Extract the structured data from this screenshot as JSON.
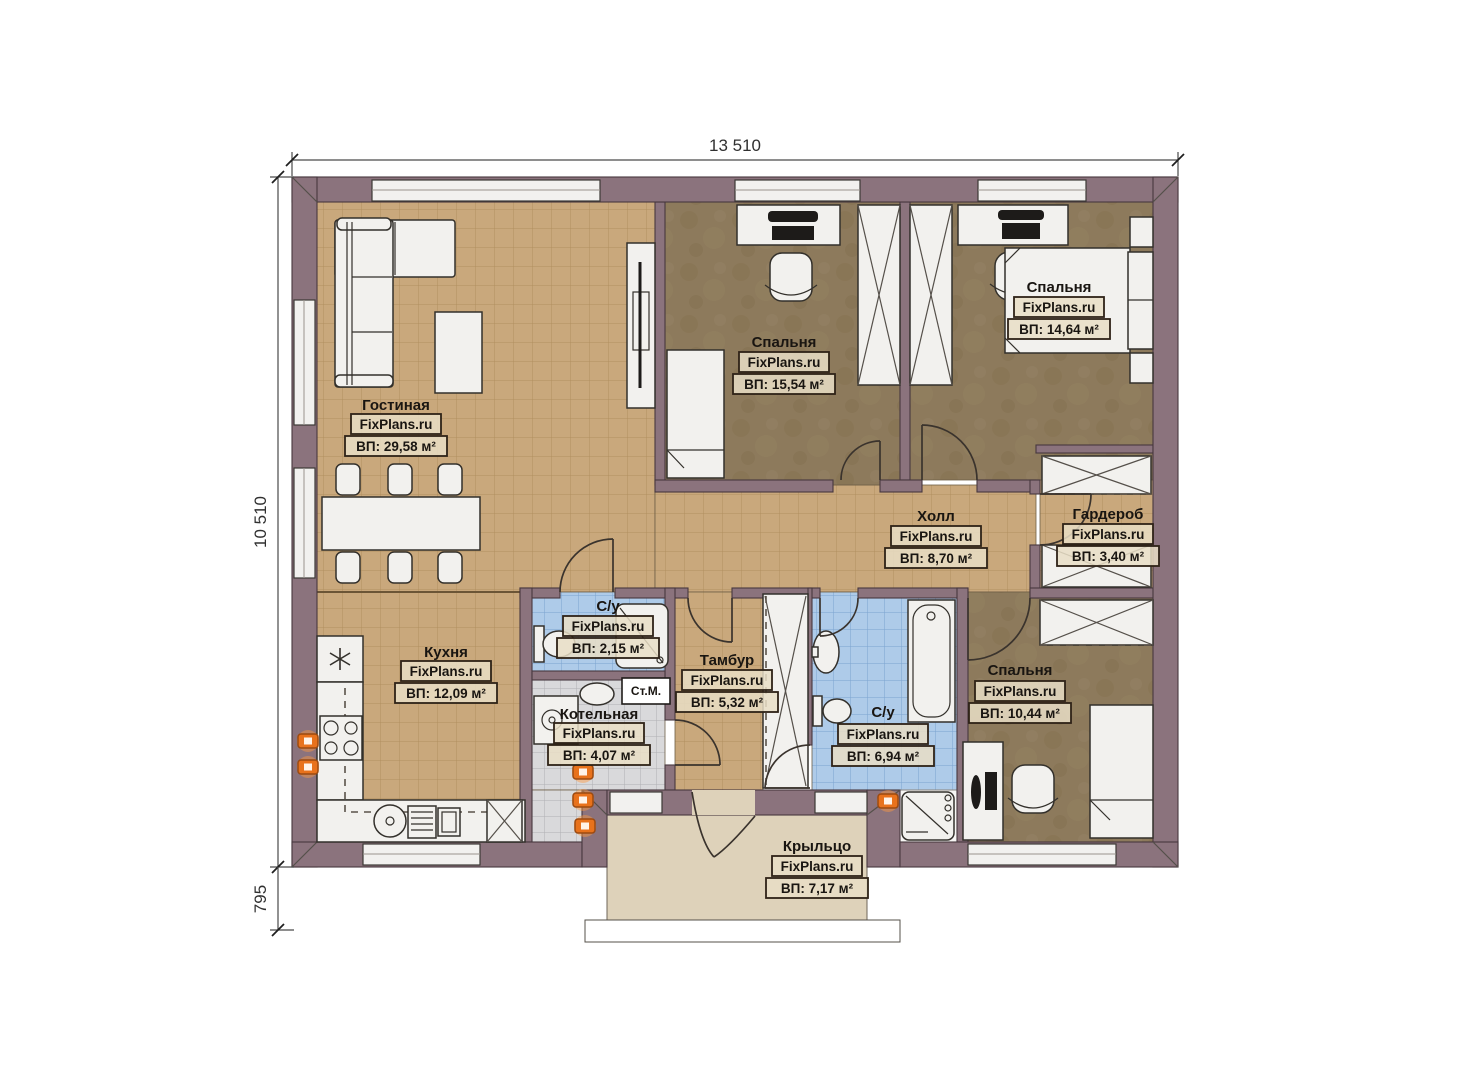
{
  "dimensions": {
    "top": "13 510",
    "left": "10 510",
    "porch": "795"
  },
  "rooms": [
    {
      "id": "living",
      "name": "Гостиная",
      "brand": "FixPlans.ru",
      "area": "ВП: 29,58 м²"
    },
    {
      "id": "bedroom1",
      "name": "Спальня",
      "brand": "FixPlans.ru",
      "area": "ВП: 15,54 м²"
    },
    {
      "id": "bedroom2",
      "name": "Спальня",
      "brand": "FixPlans.ru",
      "area": "ВП: 14,64 м²"
    },
    {
      "id": "hall",
      "name": "Холл",
      "brand": "FixPlans.ru",
      "area": "ВП: 8,70 м²"
    },
    {
      "id": "wardrobe",
      "name": "Гардероб",
      "brand": "FixPlans.ru",
      "area": "ВП: 3,40 м²"
    },
    {
      "id": "kitchen",
      "name": "Кухня",
      "brand": "FixPlans.ru",
      "area": "ВП: 12,09 м²"
    },
    {
      "id": "bath_small",
      "name": "С/у",
      "brand": "FixPlans.ru",
      "area": "ВП: 2,15 м²"
    },
    {
      "id": "vestibule",
      "name": "Тамбур",
      "brand": "FixPlans.ru",
      "area": "ВП: 5,32 м²"
    },
    {
      "id": "boiler",
      "name": "Котельная",
      "brand": "FixPlans.ru",
      "area": "ВП: 4,07 м²"
    },
    {
      "id": "bath_big",
      "name": "С/у",
      "brand": "FixPlans.ru",
      "area": "ВП: 6,94 м²"
    },
    {
      "id": "bedroom3",
      "name": "Спальня",
      "brand": "FixPlans.ru",
      "area": "ВП: 10,44 м²"
    },
    {
      "id": "porch",
      "name": "Крыльцо",
      "brand": "FixPlans.ru",
      "area": "ВП: 7,17 м²"
    }
  ],
  "labels": {
    "washing_machine": "Ст.М."
  },
  "colors": {
    "wall": "#8b737d",
    "tile_floor": "#c9a87c",
    "bedroom_floor": "#8d7a5c",
    "wet_room_tile": "#aecbe9",
    "boiler_tile": "#d9d9db",
    "porch_floor": "#ded2ba",
    "accent_orange": "#e8721c"
  }
}
